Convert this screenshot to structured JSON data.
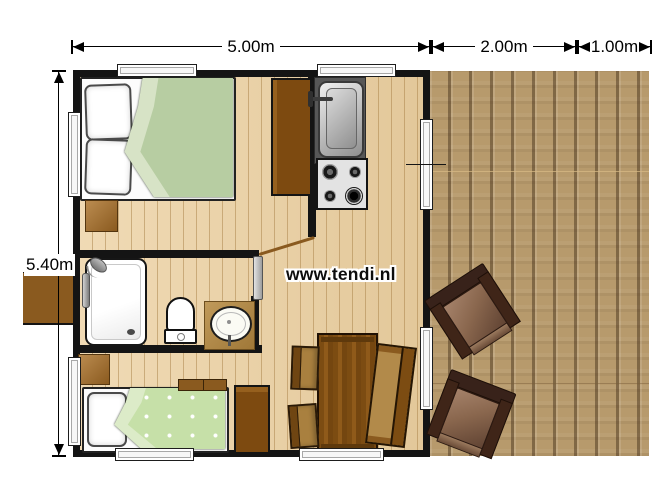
{
  "plan": {
    "dimensions": {
      "top": [
        {
          "label": "5.00m"
        },
        {
          "label": "2.00m"
        },
        {
          "label": "1.00m"
        }
      ],
      "left": {
        "label": "5.40m"
      }
    },
    "watermark": "www.tendi.nl",
    "colors": {
      "wall": "#141414",
      "interior_floor": "#ecd0a0",
      "veranda_floor": "#b79a6c",
      "furniture_dark_brown": "#7d4a10",
      "furniture_mid_brown": "#9c6820",
      "bed_double_duvet": "#b7cda2",
      "bed_single_duvet": "#c6e0a8",
      "kitchen_counter": "#575757",
      "dimension_text": "#000000"
    }
  }
}
